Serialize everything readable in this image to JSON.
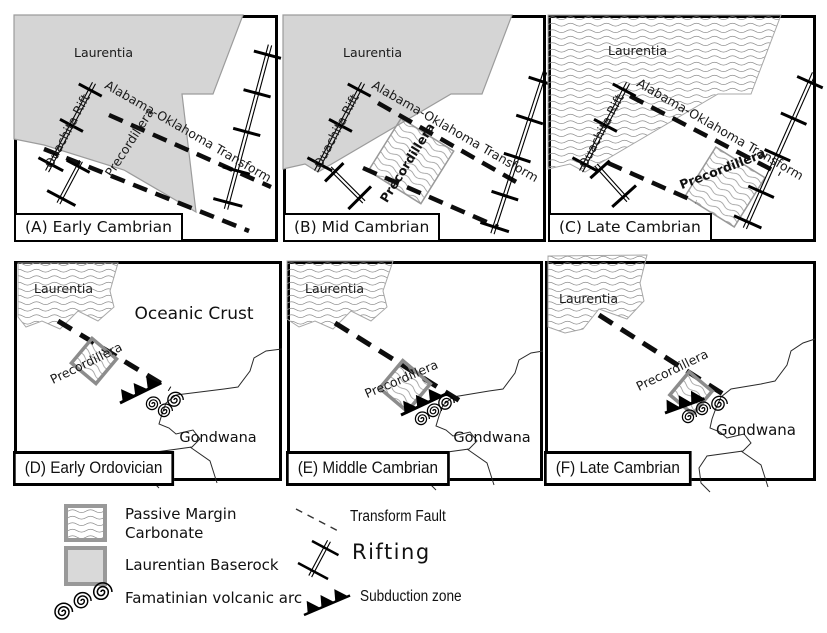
{
  "panels": [
    {
      "id": "A",
      "caption": "(A) Early Cambrian",
      "labels": {
        "laurentia": "Laurentia",
        "ouachita_rift": "Ouachita Rift",
        "transform": "Alabama-Oklahoma Transform",
        "precordillera": "Precordillera"
      }
    },
    {
      "id": "B",
      "caption": "(B) Mid Cambrian",
      "labels": {
        "laurentia": "Laurentia",
        "ouachita_rift": "Ouachita Rift",
        "transform": "Alabama-Oklahoma Transform",
        "precordillera": "Precordillera"
      }
    },
    {
      "id": "C",
      "caption": "(C) Late Cambrian",
      "labels": {
        "laurentia": "Laurentia",
        "ouachita_rift": "Ouachita Rift",
        "transform": "Alabama-Oklahoma Transform",
        "precordillera": "Precordillera"
      }
    },
    {
      "id": "D",
      "caption": "(D) Early Ordovician",
      "labels": {
        "laurentia": "Laurentia",
        "oceanic_crust": "Oceanic Crust",
        "precordillera": "Precordillera",
        "gondwana": "Gondwana"
      }
    },
    {
      "id": "E",
      "caption": "(E) Middle Cambrian",
      "labels": {
        "laurentia": "Laurentia",
        "precordillera": "Precordillera",
        "gondwana": "Gondwana"
      }
    },
    {
      "id": "F",
      "caption": "(F) Late Cambrian",
      "labels": {
        "laurentia": "Laurentia",
        "precordillera": "Precordillera",
        "gondwana": "Gondwana"
      }
    }
  ],
  "legend": {
    "passive_margin_carbonate": "Passive Margin Carbonate",
    "laurentian_baserock": "Laurentian Baserock",
    "famatinian_volcanic_arc": "Famatinian volcanic arc",
    "transform_fault": "Transform Fault",
    "rifting": "Rifting",
    "subduction_zone": "Subduction zone"
  },
  "colors": {
    "baserock_fill": "#d5d5d5",
    "swatch_border": "#999999",
    "wave_line": "#8f8f8f",
    "line": "#000000",
    "background": "#ffffff"
  }
}
